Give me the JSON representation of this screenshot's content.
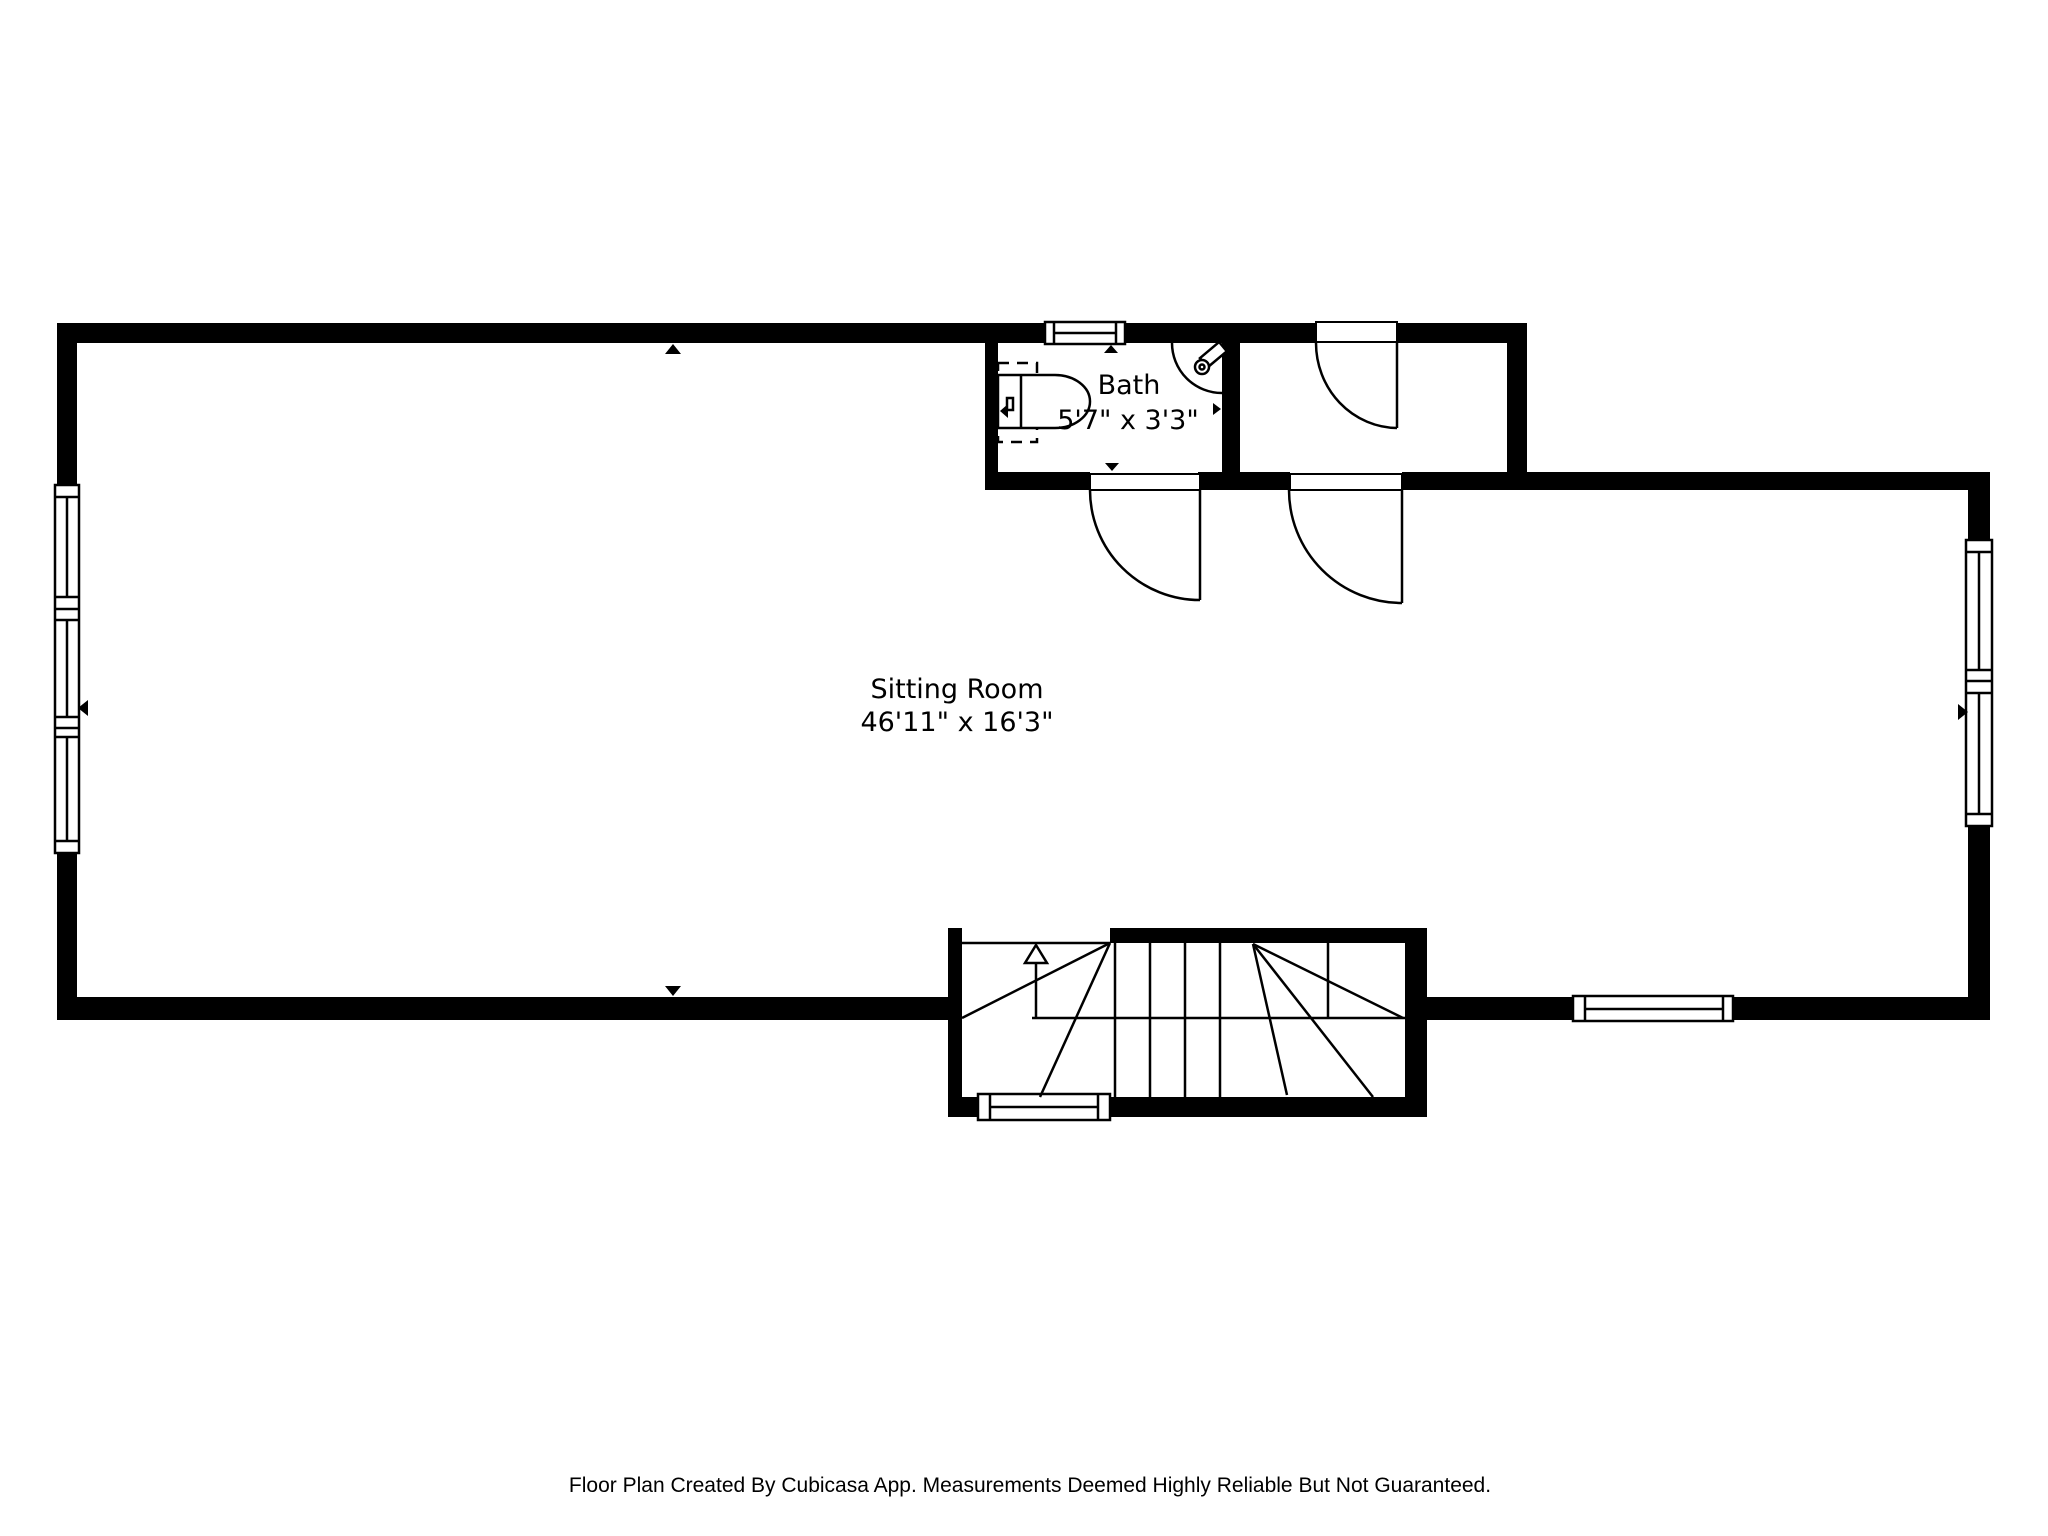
{
  "document": {
    "type": "floor-plan",
    "background_color": "#ffffff",
    "wall_color": "#000000"
  },
  "rooms": [
    {
      "id": "sitting-room",
      "name": "Sitting Room",
      "dimensions": "46'11\" x 16'3\""
    },
    {
      "id": "bath",
      "name": "Bath",
      "dimensions": "5'7\" x 3'3\""
    }
  ],
  "fixtures": [
    {
      "id": "toilet",
      "location": "bath"
    },
    {
      "id": "corner-sink",
      "location": "bath"
    },
    {
      "id": "staircase",
      "direction": "up"
    }
  ],
  "footer": {
    "text": "Floor Plan Created By Cubicasa App. Measurements Deemed Highly Reliable But Not Guaranteed."
  },
  "icons": {
    "toilet": "toilet-icon",
    "sink": "corner-sink-icon",
    "stairs_arrow": "stairs-up-arrow-icon",
    "wall_marker": "wall-direction-marker-icon",
    "window": "window-symbol",
    "door": "door-swing-symbol"
  }
}
